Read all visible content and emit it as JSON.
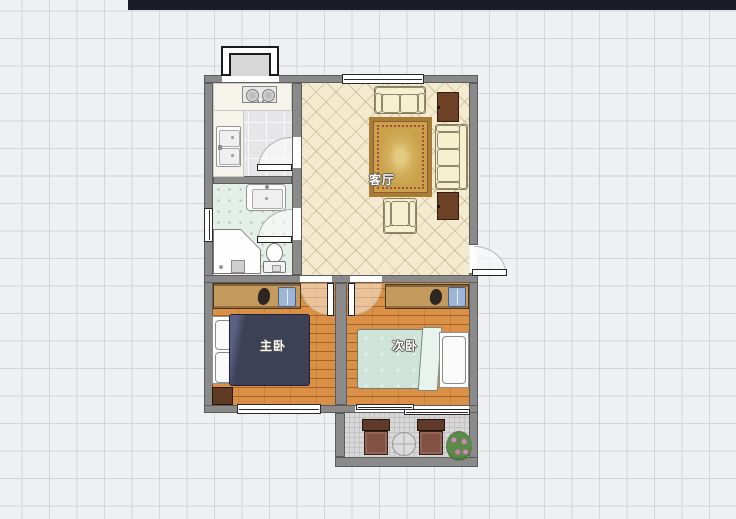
{
  "app": {
    "toolbar_color": "#1a1d28",
    "canvas_background": "#eef0f2",
    "grid_line_color": "#d3d5d8"
  },
  "rooms": {
    "living": {
      "label": "客厅"
    },
    "master": {
      "label": "主卧"
    },
    "second": {
      "label": "次卧"
    }
  },
  "colors": {
    "wall": "#8a8a8a",
    "living_floor": "#f3ead0",
    "wood_floor": "#d2873c",
    "kitchen_floor": "#e6e6e8",
    "bathroom_floor": "#e4efe8",
    "balcony_floor": "#d8d8d8",
    "master_duvet": "#3d4156",
    "second_duvet": "#cfe3d9",
    "sofa": "#f3edca",
    "cabinet": "#6d4125",
    "wardrobe": "#c49a5f",
    "rug": "#c9a24b"
  },
  "furniture_icons": [
    "bay-window",
    "stove",
    "kitchen-sink",
    "bathroom-sink",
    "corner-shower",
    "toilet",
    "two-seat-sofa",
    "three-seat-sofa",
    "armchair",
    "area-rug",
    "tv-cabinet",
    "side-cabinet",
    "double-bed",
    "single-bed",
    "wardrobe",
    "nightstand",
    "balcony-chair",
    "balcony-table",
    "potted-plant",
    "swing-door",
    "sliding-window"
  ]
}
